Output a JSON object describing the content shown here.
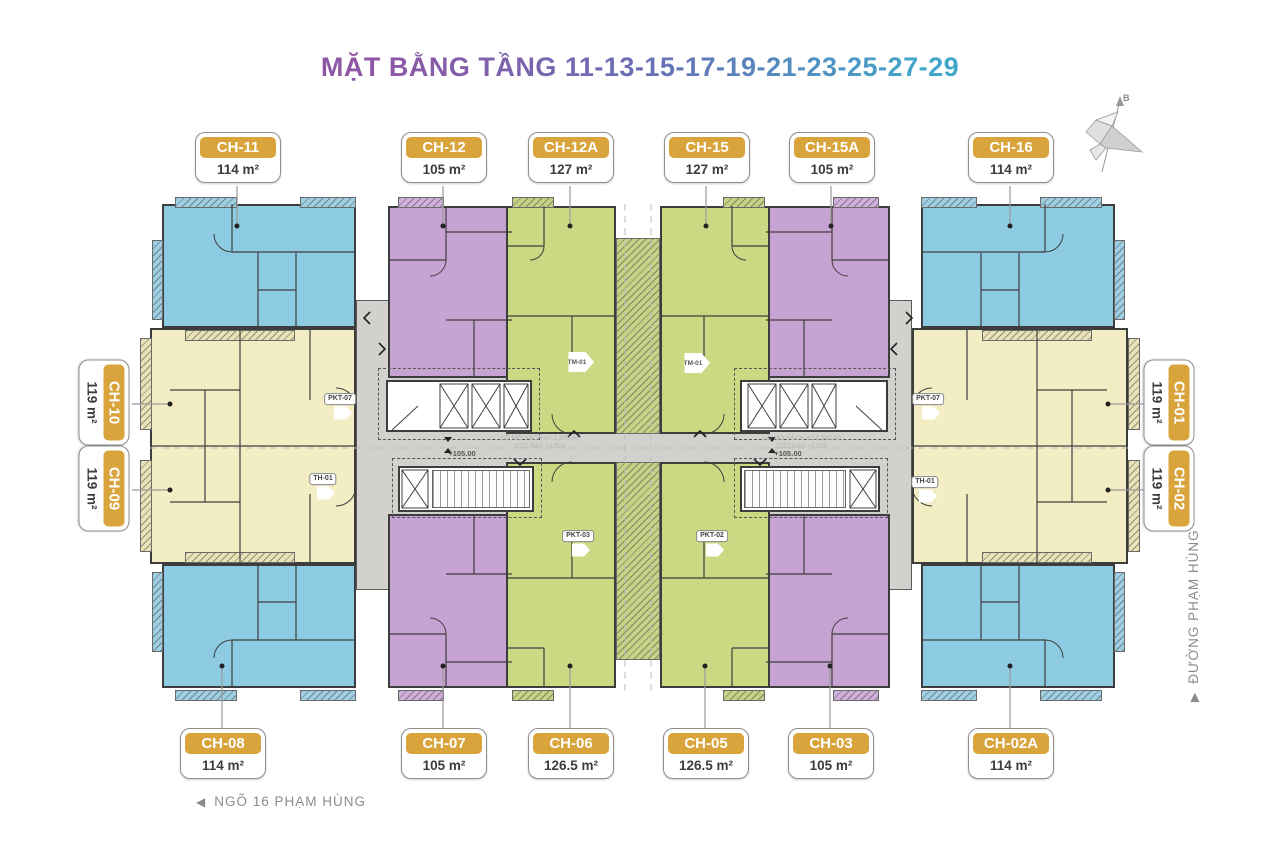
{
  "title": "MẶT BẰNG TẦNG 11-13-15-17-19-21-23-25-27-29",
  "compass": {
    "north_label": "B"
  },
  "streets": {
    "bottom": {
      "arrow": "◀",
      "name": "NGÕ 16 PHẠM HÙNG"
    },
    "right": {
      "arrow": "▶",
      "name": "ĐƯỜNG PHẠM HÙNG"
    }
  },
  "legend_labels": {
    "top": [
      {
        "id": "CH-11",
        "area": "114 m²"
      },
      {
        "id": "CH-12",
        "area": "105 m²"
      },
      {
        "id": "CH-12A",
        "area": "127 m²"
      },
      {
        "id": "CH-15",
        "area": "127 m²"
      },
      {
        "id": "CH-15A",
        "area": "105 m²"
      },
      {
        "id": "CH-16",
        "area": "114 m²"
      }
    ],
    "bottom": [
      {
        "id": "CH-08",
        "area": "114 m²"
      },
      {
        "id": "CH-07",
        "area": "105 m²"
      },
      {
        "id": "CH-06",
        "area": "126.5 m²"
      },
      {
        "id": "CH-05",
        "area": "126.5 m²"
      },
      {
        "id": "CH-03",
        "area": "105 m²"
      },
      {
        "id": "CH-02A",
        "area": "114 m²"
      }
    ],
    "left": [
      {
        "id": "CH-10",
        "area": "119 m²"
      },
      {
        "id": "CH-09",
        "area": "119 m²"
      }
    ],
    "right": [
      {
        "id": "CH-01",
        "area": "119 m²"
      },
      {
        "id": "CH-02",
        "area": "119 m²"
      }
    ]
  },
  "plan_annotations": {
    "tm01": "TM-01",
    "pkt07": "PKT-07",
    "th01": "TH-01",
    "pkt03": "PKT-03",
    "pkt02": "PKT-02",
    "level": "+105.00",
    "fine_print_1": "LỖ MỞ VÁCH KT.1.300.00",
    "fine_print_2": "CỐT ĐÁY +3.525"
  },
  "colors": {
    "unit_blue": "#8ccbe2",
    "unit_purple": "#c7a3d3",
    "unit_green": "#cbd983",
    "unit_yellow": "#f3edc3",
    "corridor_gray": "#d2d1cd",
    "label_gold": "#d9a43c",
    "title_purple": "#8d57a6",
    "title_blue": "#41a6ca"
  }
}
